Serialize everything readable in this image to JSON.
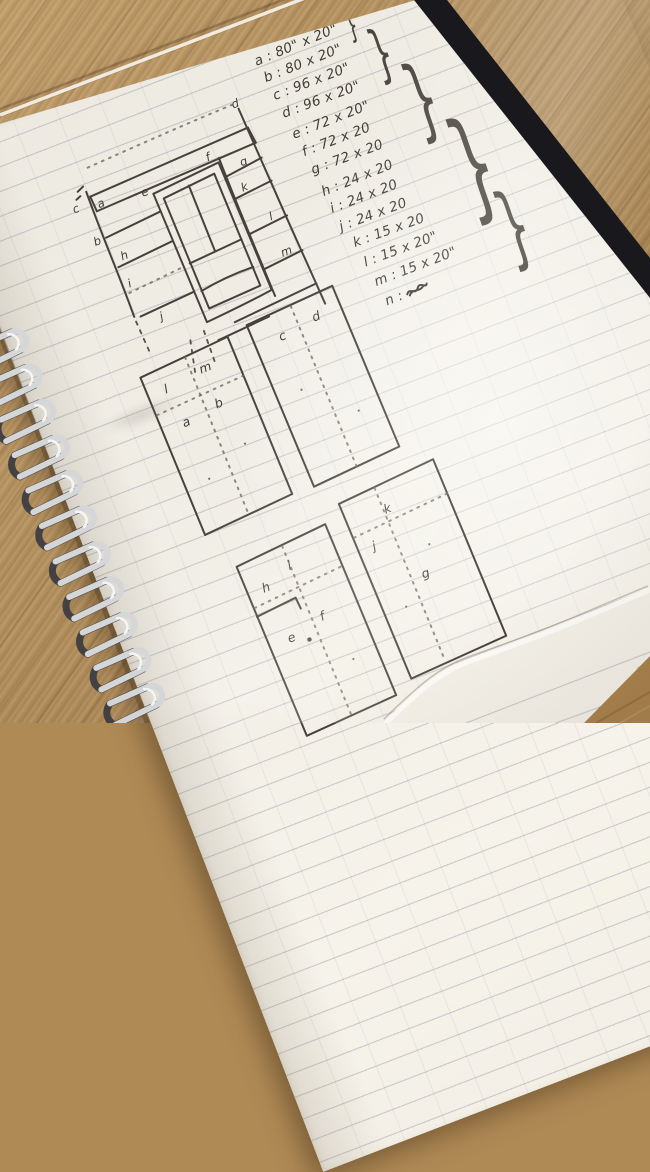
{
  "notebook": {
    "cut_list": {
      "items": [
        "a : 80\" x 20\"",
        "b : 80 x 20\"",
        "c : 96 x 20\"",
        "d : 96 x 20\"",
        "e : 72 x 20\"",
        "f : 72 x 20",
        "g : 72 x 20",
        "h : 24 x 20",
        "i : 24 x 20",
        "j : 24 x 20",
        "k : 15 x 20",
        "l : 15 x 20\"",
        "m : 15 x 20\"",
        "n :"
      ],
      "brace_glyph": "}"
    },
    "elevation": {
      "labels": {
        "a": "a",
        "b": "b",
        "c": "c",
        "d": "d",
        "e": "e",
        "f": "f",
        "g": "g",
        "h": "h",
        "i": "i",
        "j": "j",
        "k": "k",
        "l": "l",
        "m": "m"
      }
    },
    "sheets": [
      {
        "labels": [
          "l",
          "m",
          "a",
          "b"
        ]
      },
      {
        "labels": [
          "c",
          "d"
        ]
      },
      {
        "labels": [
          "h",
          "i",
          "e",
          "f"
        ]
      },
      {
        "labels": [
          "k",
          "j",
          "g"
        ]
      }
    ]
  }
}
